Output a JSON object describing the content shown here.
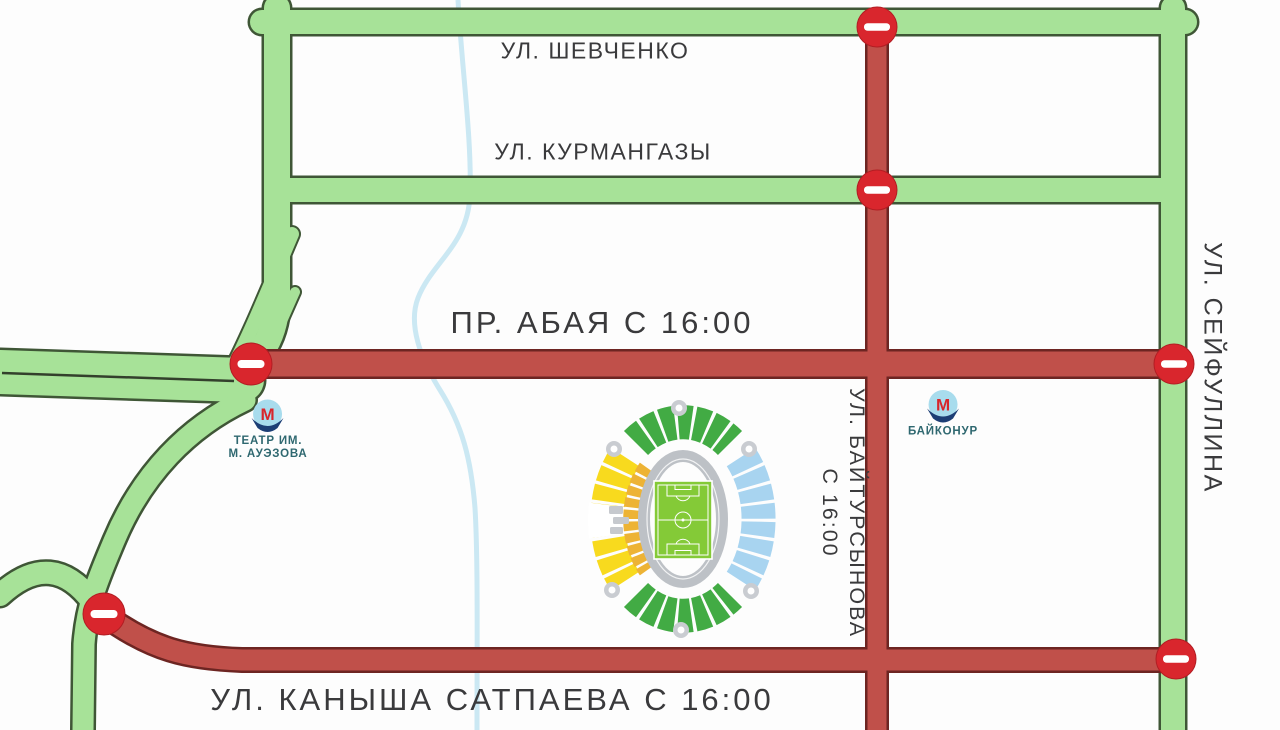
{
  "streets": {
    "shevchenko": "УЛ. ШЕВЧЕНКО",
    "kurmangazy": "УЛ. КУРМАНГАЗЫ",
    "abay": "ПР. АБАЯ С 16:00",
    "baytursynov_line1": "УЛ. БАЙТУРСЫНОВА",
    "baytursynov_line2": "С 16:00",
    "seyfullin": "УЛ. СЕЙФУЛЛИНА",
    "satpayev": "УЛ. КАНЫША САТПАЕВА С 16:00"
  },
  "metro": {
    "logo_letter": "М",
    "auezov_line1": "ТЕАТР ИМ.",
    "auezov_line2": "М. АУЭЗОВА",
    "baikonur_line1": "БАЙКОНУР",
    "baikonur_line2": ""
  },
  "legend": {
    "open_road_color": "#a7e298",
    "closed_road_color": "#c0504a",
    "no_entry_sign_color": "#d9262d",
    "river_color": "#cbe8f3",
    "stadium_pitch_color": "#84ca37",
    "no_entry_sign_count": 6,
    "closure_time": "С 16:00"
  }
}
